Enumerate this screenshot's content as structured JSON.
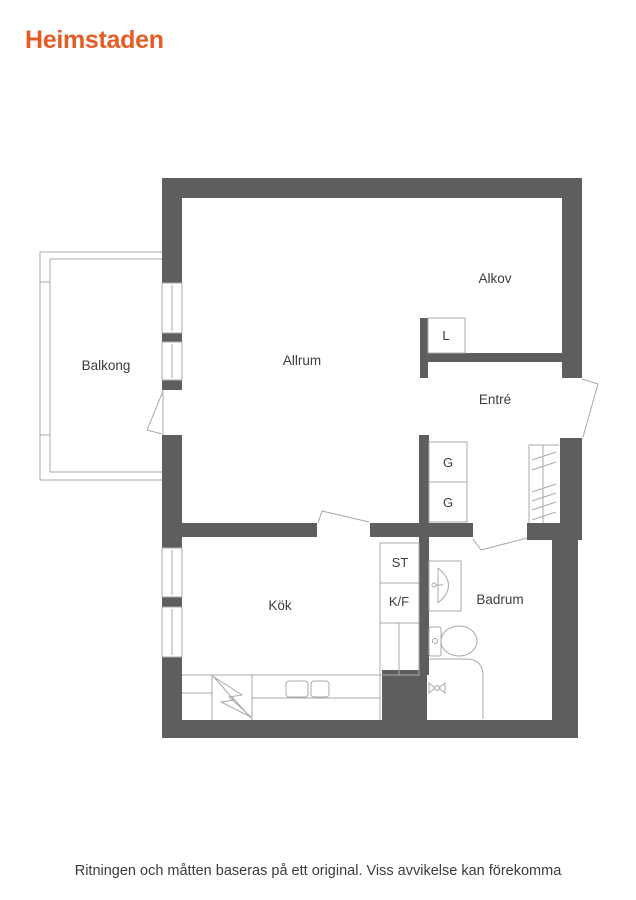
{
  "brand": {
    "name": "Heimstaden",
    "color": "#e55c25"
  },
  "floorplan": {
    "wall_color": "#5e5e5e",
    "line_color": "#a9a9a9",
    "label_color": "#3d3d3d",
    "rooms": {
      "balkong": "Balkong",
      "allrum": "Allrum",
      "alkov": "Alkov",
      "entre": "Entré",
      "kok": "Kök",
      "badrum": "Badrum"
    },
    "fixtures": {
      "linen_closet": "L",
      "wardrobe_upper": "G",
      "wardrobe_lower": "G",
      "cleaning_closet": "ST",
      "fridge_freezer": "K/F"
    }
  },
  "footer": {
    "disclaimer": "Ritningen och måtten baseras på ett original. Viss avvikelse kan förekomma"
  }
}
